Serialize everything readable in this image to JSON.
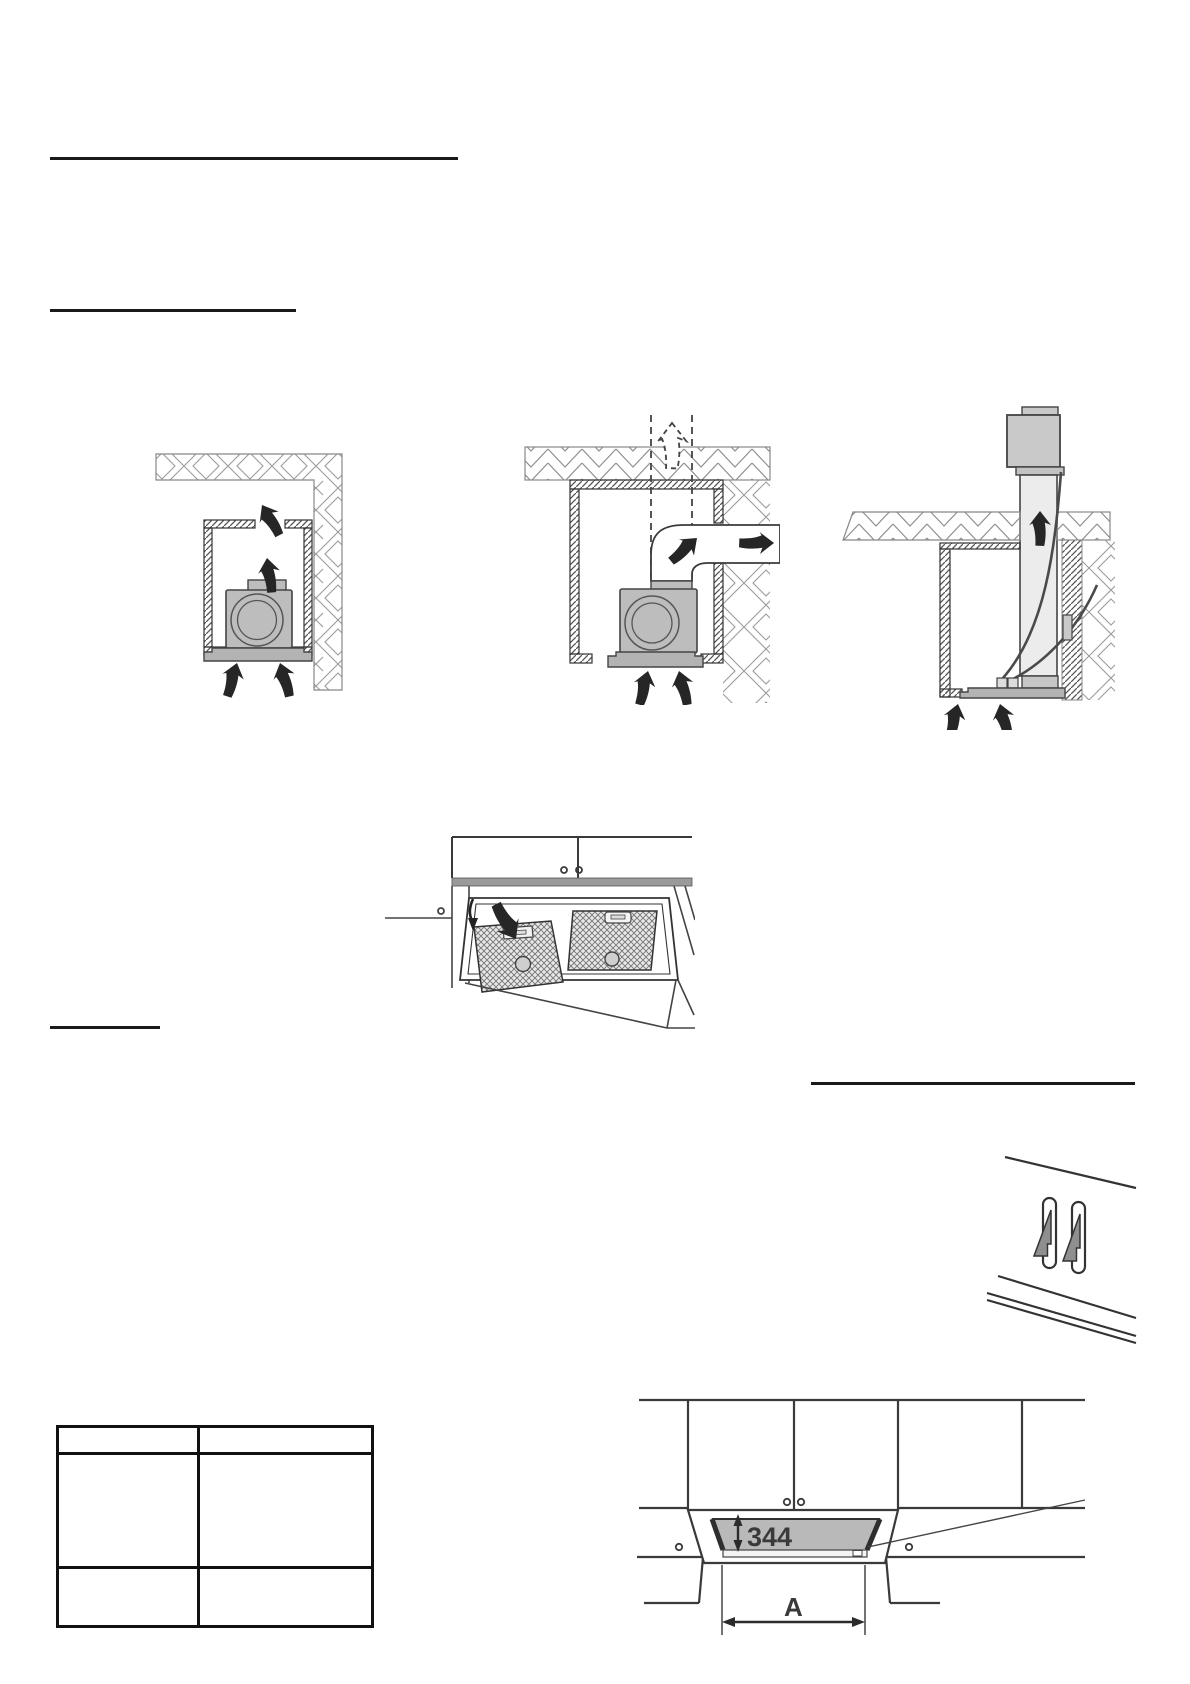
{
  "dimensions": {
    "cutout_height": "344",
    "cutout_width_label": "A"
  },
  "table": {
    "columns": 2,
    "rows": 3,
    "cells": [
      [
        "",
        ""
      ],
      [
        "",
        ""
      ],
      [
        "",
        ""
      ]
    ]
  },
  "colors": {
    "rule": "#1a1a1a",
    "line": "#3a3a3a",
    "unit_gray": "#bdbdbd",
    "duct_gray": "#ececec",
    "aperture_gray": "#b9b9b9",
    "hook_gray": "#8f8f8f",
    "dim_label": "#3a3a3a"
  },
  "figures": {
    "recirculation": "blower-recirculating-inside-cabinet",
    "side_duct": "blower-ducted-through-side-wall",
    "remote_blower": "remote-blower-above-ceiling",
    "filters": "grease-filter-removal",
    "hooks": "mounting-hooks-in-slots",
    "cutout": "cabinet-cutout-dimensions"
  }
}
